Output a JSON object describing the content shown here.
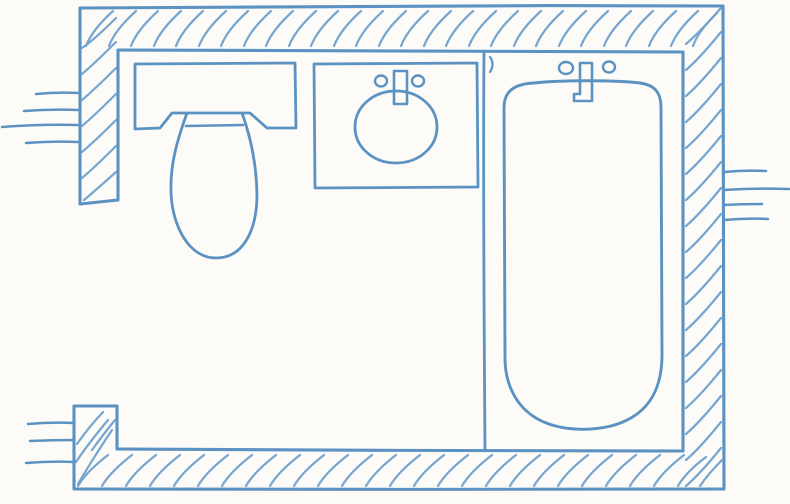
{
  "meta": {
    "title": "Hand-drawn bathroom floor plan sketch",
    "style": "blue ink on white paper"
  },
  "palette": {
    "ink": "#5b92c2",
    "ink2": "#6fa0cc",
    "paper": "#fcfbf7"
  },
  "diagram": {
    "type": "floor-plan-sketch",
    "subject": "bathroom",
    "fixtures": [
      {
        "name": "toilet",
        "parts": [
          "tank",
          "bowl"
        ]
      },
      {
        "name": "sink",
        "parts": [
          "counter",
          "basin",
          "faucet",
          "left handle",
          "right handle"
        ]
      },
      {
        "name": "bathtub",
        "parts": [
          "tub",
          "faucet",
          "left handle",
          "right handle"
        ]
      }
    ],
    "features": [
      "hatched exterior walls",
      "doorway opening on left side",
      "partition wall before bathtub",
      "service lines upper-left (4)",
      "service lines lower-left (3)",
      "service lines right (4)"
    ]
  },
  "drawing": {
    "canvas": {
      "width": 790,
      "height": 504
    },
    "paths": [
      {
        "name": "wall-outline",
        "color": "ink",
        "w": 3.1,
        "d": "M80,8 C290,6 508,5 723,6 C723,170 724,330 724,489 C508,489 290,490 74,489 L74,406 L117,406 L117,449 C306,450 494,451 683,451 C683,318 683,185 683,52 C494,51 306,50 118,50 L118,200 L80,204 Z"
      },
      {
        "name": "wall-hatch-top",
        "color": "ink2",
        "w": 2.2,
        "opacity": 0.95,
        "d": "M86,46 Q92,30 113,11 M109,46 Q115,30 136,11 M131,46 Q137,30 158,11 M154,46 Q160,30 181,11 M176,46 Q182,30 203,11 M199,46 Q205,30 226,11 M221,46 Q227,30 248,11 M244,46 Q250,30 271,11 M266,46 Q272,30 293,11 M289,46 Q295,30 316,11 M311,46 Q317,30 338,11 M334,46 Q340,30 361,11 M356,46 Q362,30 383,11 M379,46 Q385,30 406,11 M401,46 Q407,30 428,11 M424,46 Q430,30 451,11 M446,46 Q452,30 473,11 M469,46 Q475,30 496,11 M491,46 Q497,30 518,11 M514,46 Q520,30 541,11 M536,46 Q542,30 563,11 M559,46 Q565,30 586,11 M581,46 Q587,30 608,11 M604,46 Q610,30 631,11 M626,46 Q632,30 653,11 M649,46 Q655,30 676,11 M671,46 Q677,30 698,11 M693,46 Q699,30 717,13"
      },
      {
        "name": "wall-hatch-left",
        "color": "ink2",
        "w": 2.2,
        "opacity": 0.95,
        "d": "M82,48 Q94,40 116,18 M82,74 Q94,64 116,42 M82,100 Q94,90 116,68 M82,126 Q94,116 116,94 M82,152 Q94,142 116,120 M82,178 Q94,168 116,146 M84,200 Q96,190 116,172"
      },
      {
        "name": "wall-hatch-right",
        "color": "ink2",
        "w": 2.2,
        "opacity": 0.95,
        "d": "M686,44 Q700,32 721,8 M686,70 Q700,58 721,32 M686,96 Q700,84 721,58 M686,122 Q700,110 721,84 M686,148 Q700,136 721,110 M686,174 Q700,162 721,136 M686,200 Q700,188 721,162 M686,226 Q700,214 721,188 M686,252 Q700,240 721,214 M686,278 Q700,266 721,240 M686,304 Q700,292 721,266 M686,330 Q700,318 721,292 M686,356 Q700,344 721,318 M686,382 Q700,370 721,344 M686,408 Q700,396 721,370 M686,434 Q700,422 721,396 M686,460 Q700,448 721,422 M686,486 Q700,474 721,448"
      },
      {
        "name": "wall-hatch-bottom",
        "color": "ink2",
        "w": 2.2,
        "opacity": 0.95,
        "d": "M78,486 Q86,472 108,455 M102,486 Q110,472 132,455 M126,486 Q134,472 156,455 M150,486 Q158,472 180,455 M174,486 Q182,472 204,455 M198,486 Q206,472 228,455 M222,486 Q230,472 252,455 M246,486 Q254,472 276,455 M270,486 Q278,472 300,455 M294,486 Q302,472 324,455 M318,486 Q326,472 348,455 M342,486 Q350,472 372,455 M366,486 Q374,472 396,455 M390,486 Q398,472 420,455 M414,486 Q422,472 444,455 M438,486 Q446,472 468,455 M462,486 Q470,472 492,455 M486,486 Q494,472 516,455 M510,486 Q518,472 540,455 M534,486 Q542,472 564,455 M558,486 Q566,472 588,455 M582,486 Q590,472 612,455 M606,486 Q614,472 636,455 M630,486 Q638,472 660,455 M654,486 Q662,472 684,455 M678,486 Q686,472 706,457 M700,486 Q708,474 722,460"
      },
      {
        "name": "wall-hatch-door-stub",
        "color": "ink2",
        "w": 2.2,
        "opacity": 0.95,
        "d": "M78,484 Q92,460 112,430 M76,462 Q88,444 108,420 M77,444 Q88,428 103,412 M92,450 Q102,436 115,420"
      },
      {
        "name": "partition-wall",
        "color": "ink",
        "w": 2.8,
        "d": "M484,53 C483,170 484,315 485,450"
      },
      {
        "name": "pen-mark-partition-top",
        "color": "ink",
        "w": 2.2,
        "d": "M490,57 Q495,64 490,72"
      },
      {
        "name": "toilet-tank",
        "color": "ink",
        "w": 2.8,
        "d": "M135,64 L295,63 L296,128 L267,128 L250,113 L172,113 L160,128 L135,129 Z"
      },
      {
        "name": "toilet-bowl",
        "color": "ink",
        "w": 2.8,
        "d": "M187,113 C178,138 170,163 171,192 C172,226 189,258 216,258 C243,258 256,231 257,198 C257,165 251,138 242,113"
      },
      {
        "name": "toilet-bowl-rim",
        "color": "ink",
        "w": 2.6,
        "d": "M186,126 L243,125"
      },
      {
        "name": "sink-counter",
        "color": "ink",
        "w": 2.8,
        "d": "M314,64 L477,63 L478,187 L315,188 Z"
      },
      {
        "name": "sink-basin",
        "color": "ink",
        "w": 2.8,
        "d": "M355,127 C355,107 373,91 396,91 C419,91 437,107 437,127 C437,147 419,163 396,163 C373,163 355,147 355,127 Z"
      },
      {
        "name": "sink-faucet",
        "color": "ink",
        "w": 2.6,
        "d": "M394,71 L407,71 L407,104 L394,104 Z"
      },
      {
        "name": "sink-handle-left",
        "color": "ink",
        "w": 2.4,
        "d": "M375,81 A6,5.5 0 1 0 387,81 A6,5.5 0 1 0 375,81"
      },
      {
        "name": "sink-handle-right",
        "color": "ink",
        "w": 2.4,
        "d": "M412,81 A6,5.5 0 1 0 424,81 A6,5.5 0 1 0 412,81"
      },
      {
        "name": "bathtub-outline",
        "color": "ink",
        "w": 2.9,
        "d": "M534,83 C560,80 616,80 640,83 C655,85 661,93 661,107 L662,355 C662,394 645,417 611,426 C586,432 556,430 536,418 C516,406 505,384 505,358 L504,108 C504,92 513,84 534,83 Z"
      },
      {
        "name": "tub-faucet",
        "color": "ink",
        "w": 2.6,
        "d": "M580,63 L592,63 L592,101 L574,101 L574,94 L580,94 Z"
      },
      {
        "name": "tub-handle-left",
        "color": "ink",
        "w": 2.4,
        "d": "M559,68 A7,6 0 1 0 573,68 A7,6 0 1 0 559,68"
      },
      {
        "name": "tub-handle-right",
        "color": "ink",
        "w": 2.4,
        "d": "M603,67 A6,5.5 0 1 0 615,67 A6,5.5 0 1 0 603,67"
      },
      {
        "name": "service-lines-left-upper",
        "color": "ink",
        "w": 2.5,
        "d": "M36,94 Q56,92 78,93 M24,111 Q50,109 78,110 M2,127 Q40,124 78,125 M26,143 Q52,141 78,142"
      },
      {
        "name": "service-lines-left-lower",
        "color": "ink",
        "w": 2.5,
        "d": "M28,424 Q50,422 74,423 M30,441 Q52,440 74,440 M26,463 Q50,461 74,462"
      },
      {
        "name": "service-lines-right",
        "color": "ink",
        "w": 2.5,
        "d": "M724,172 Q744,170 766,171 M724,190 Q756,188 789,189 M724,205 Q742,204 762,204 M724,220 Q746,218 768,219"
      }
    ]
  }
}
